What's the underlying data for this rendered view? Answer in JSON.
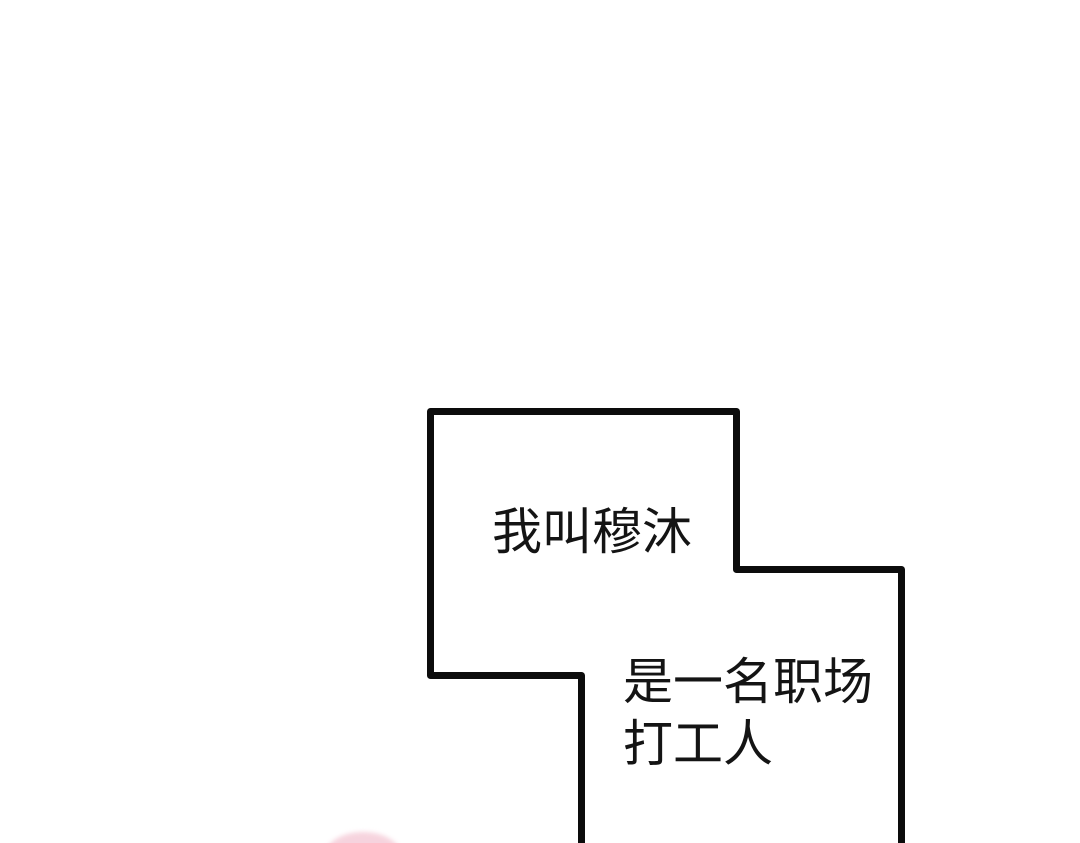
{
  "page": {
    "kind": "comic-page-segment",
    "background_color": "#ffffff"
  },
  "panel": {
    "border_color": "#0c0c0c",
    "fill_color": "#ffffff",
    "captions": {
      "intro": "我叫穆沐",
      "job_line1": "是一名职场",
      "job_line2": "打工人"
    }
  },
  "decorations": {
    "pink_shape_color": "#f4c9d6"
  }
}
